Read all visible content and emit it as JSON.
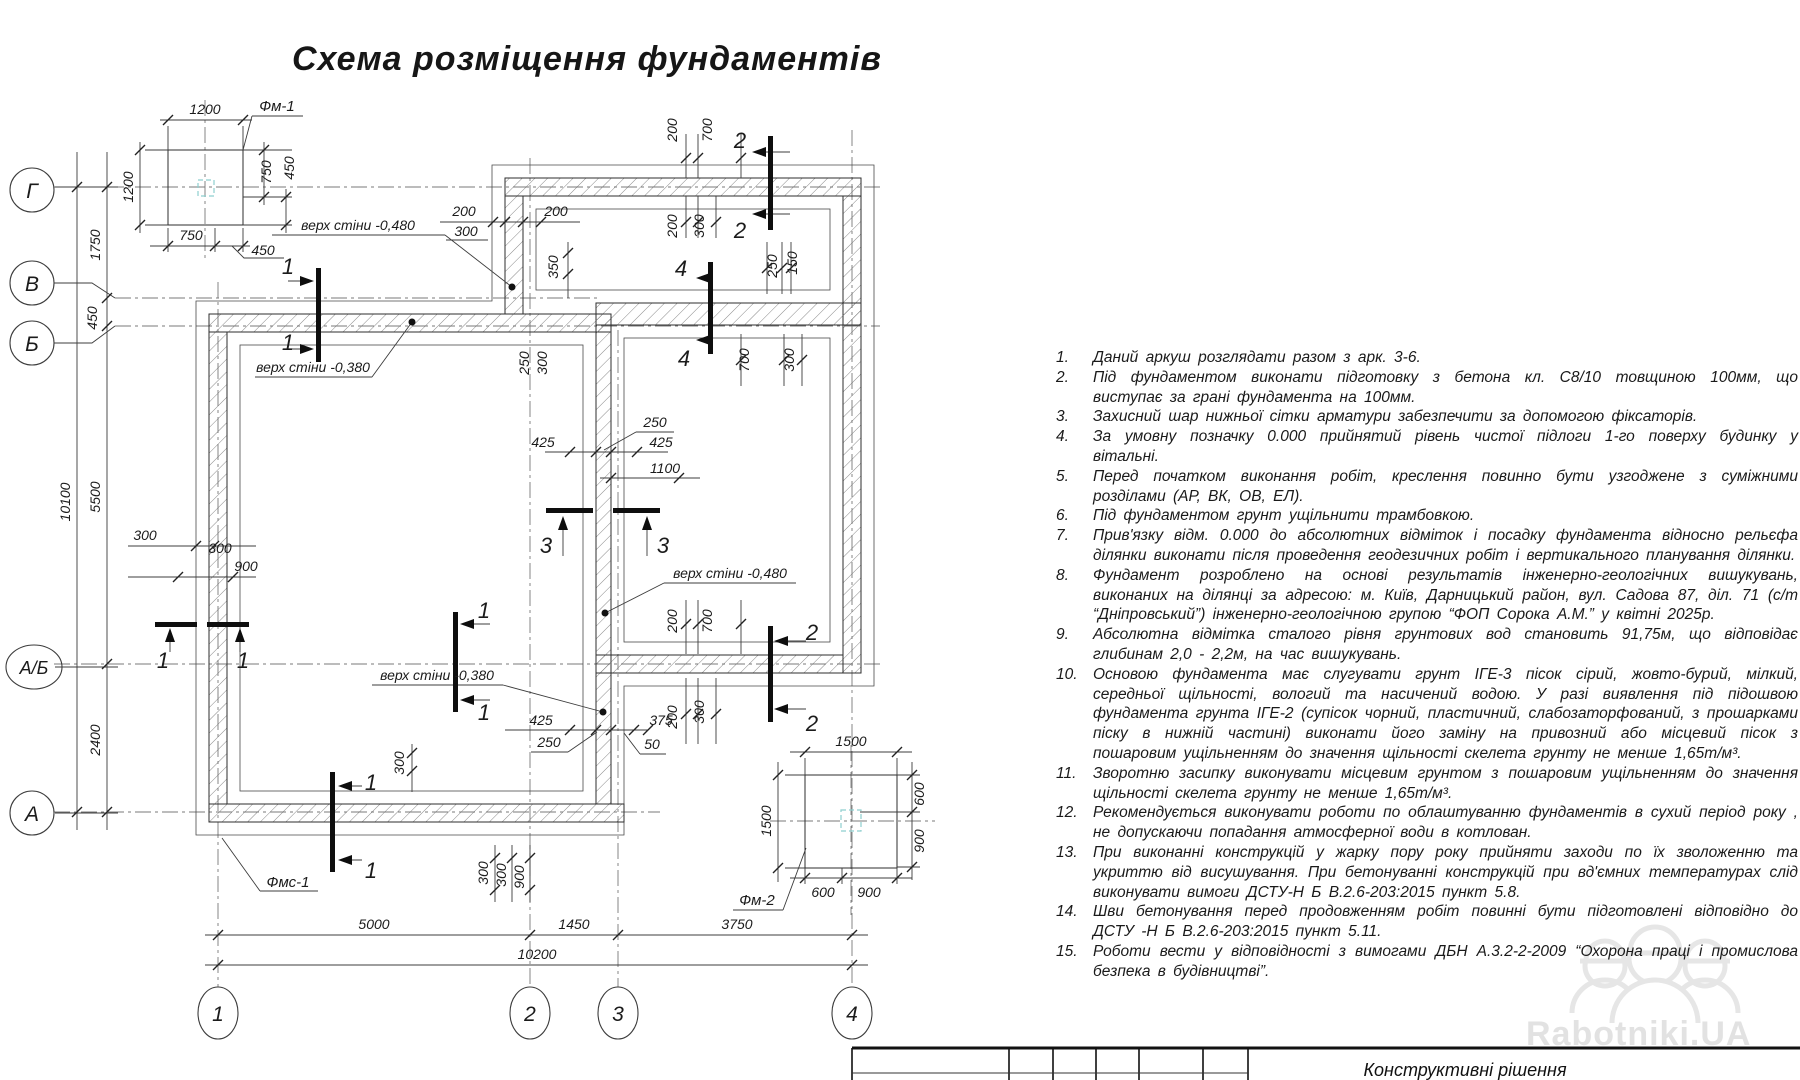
{
  "title": "Схема розміщення фундаментів",
  "watermark": {
    "text": "Rabotniki.UA"
  },
  "titleblock": {
    "title": "Конструктивні рішення"
  },
  "axes": {
    "left": {
      "g": "Г",
      "v": "В",
      "b": "Б",
      "ab": "А/Б",
      "a": "А"
    },
    "bottom": {
      "n1": "1",
      "n2": "2",
      "n3": "3",
      "n4": "4"
    }
  },
  "sections": {
    "s1": "1",
    "s2": "2",
    "s3": "3",
    "s4": "4"
  },
  "elevations": {
    "w480": "верх стіни -0,480",
    "w380": "верх стіни -0,380"
  },
  "details": {
    "fm1": {
      "label": "Фм-1",
      "size_top": "1200",
      "size_left": "1200",
      "right_a": "750",
      "right_b": "450",
      "bottom_a": "750",
      "bottom_b": "450"
    },
    "fm2": {
      "label": "Фм-2",
      "size_top": "1500",
      "size_left": "1500",
      "right_a": "600",
      "right_b": "900",
      "bottom_a": "600",
      "bottom_b": "900"
    },
    "fms1": {
      "label": "Фмс-1"
    }
  },
  "dims": {
    "left_total": "10100",
    "left_gv": "1750",
    "left_vb": "450",
    "left_bab": "5500",
    "left_aba": "2400",
    "bottom_12": "5000",
    "bottom_23": "1450",
    "bottom_34": "3750",
    "bottom_total": "10200",
    "lw_a": "300",
    "lw_b": "300",
    "lw_c": "900",
    "top_a": "200",
    "top_b": "300",
    "top_c": "200",
    "top_d": "350",
    "tr_a": "200",
    "tr_b": "700",
    "tr_c": "200",
    "tr_d": "300",
    "s4_a": "250",
    "s4_b": "150",
    "rr_a": "700",
    "rr_b": "300",
    "mid_a": "250",
    "mid_b": "300",
    "mid_c": "425",
    "mid_d": "250",
    "mid_e": "425",
    "mid_f": "1100",
    "bm_a": "425",
    "bm_b": "250",
    "bm_c": "375",
    "bm_d": "50",
    "rb_a": "200",
    "rb_b": "700",
    "rb_c": "200",
    "rb_d": "300",
    "bl_a": "300",
    "bl_b": "300",
    "bl_c": "300",
    "bl_d": "900"
  },
  "notes": [
    {
      "num": "1.",
      "text": "Даний аркуш розглядати разом з арк. 3-6."
    },
    {
      "num": "2.",
      "text": "Під фундаментом виконати підготовку з бетона кл. С8/10 товщиною 100мм, що виступає за грані фундамента на 100мм."
    },
    {
      "num": "3.",
      "text": "Захисний шар нижньої сітки арматури забезпечити за допомогою фіксаторів."
    },
    {
      "num": "4.",
      "text": "За умовну позначку 0.000 прийнятий рівень чистої підлоги 1-го поверху будинку у вітальні."
    },
    {
      "num": "5.",
      "text": "Перед початком виконання робіт, креслення повинно бути узгоджене з суміжними розділами (АР, ВК, ОВ, ЕЛ)."
    },
    {
      "num": "6.",
      "text": "Під фундаментом грунт ущільнити трамбовкою."
    },
    {
      "num": "7.",
      "text": "Прив'язку відм. 0.000 до абсолютних відміток і посадку фундамента відносно рельєфа ділянки виконати після проведення геодезичних робіт і вертикального планування ділянки."
    },
    {
      "num": "8.",
      "text": "Фундамент розроблено на основі результатів інженерно-геологічних вишукувань, виконаних на ділянці за адресою: м. Київ, Дарницький район, вул. Садова 87, діл. 71 (с/т “Дніпровський”) інженерно-геологічною групою “ФОП Сорока А.М.” у квітні 2025р."
    },
    {
      "num": "9.",
      "text": "Абсолютна відмітка сталого рівня грунтових вод становить 91,75м, що відповідає глибинам 2,0 - 2,2м, на час вишукувань."
    },
    {
      "num": "10.",
      "text": "Основою фундамента має слугувати грунт ІГЕ-3 пісок сірий, жовто-бурий, мілкий, середньої щільності, вологий та насичений водою. У разі виявлення під підошвою фундамента грунта ІГЕ-2 (супісок чорний, пластичний, слабозаторфований, з прошарками піску в нижній частині) виконати його заміну на привозний або місцевий пісок з пошаровим ущільненням до значення щільності скелета грунту не менше 1,65т/м³."
    },
    {
      "num": "11.",
      "text": "Зворотню засипку виконувати місцевим грунтом з пошаровим ущільненням до значення щільності скелета грунту не менше 1,65т/м³."
    },
    {
      "num": "12.",
      "text": "Рекомендується виконувати роботи по облаштуванню фундаментів в сухий період року , не допускаючи попадання атмосферної води в котлован."
    },
    {
      "num": "13.",
      "text": "При виконанні конструкцій у жарку пору року прийняти заходи по їх зволоженню та укриттю від висушування. При бетонуванні конструкцій при вд'ємних температурах слід виконувати вимоги ДСТУ-Н Б В.2.6-203:2015 пункт 5.8."
    },
    {
      "num": "14.",
      "text": "Шви бетонування перед продовженням робіт повинні бути підготовлені відповідно до ДСТУ -Н Б В.2.6-203:2015 пункт 5.11."
    },
    {
      "num": "15.",
      "text": "Роботи вести у відповідності з вимогами ДБН А.3.2-2-2009 “Охорона праці і промислова безпека в будівництві”."
    }
  ]
}
